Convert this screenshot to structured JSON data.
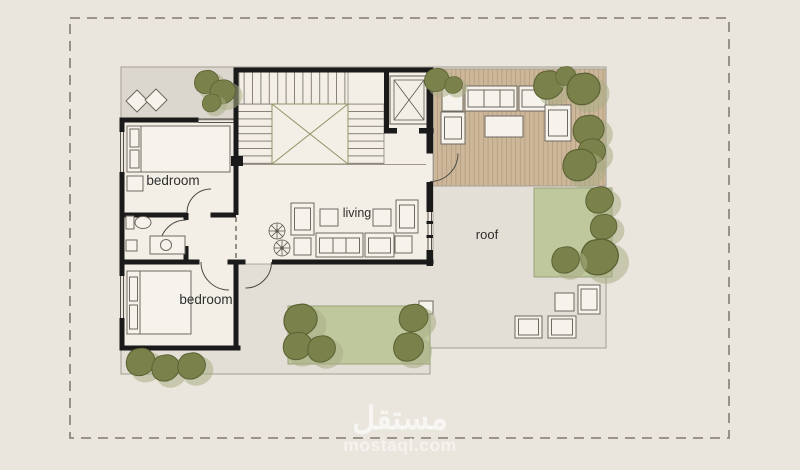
{
  "floor_plan": {
    "room_labels": {
      "bedroom_upper": "bedroom",
      "bedroom_lower": "bedroom",
      "living": "living",
      "roof": "roof"
    },
    "watermark": {
      "site_name_arabic": "مستقل",
      "site_name_latin": "mostaql.com"
    },
    "colors": {
      "background": "#eae6de",
      "slab": "#e3ded6",
      "room": "#f3efe7",
      "terrace": "#dcd7ce",
      "deck_wood": "#cdb79b",
      "grass": "#bfc79d",
      "tree": "#7b814a",
      "wall": "#1a1a1a",
      "boundary_dash": "#8e897f"
    }
  }
}
